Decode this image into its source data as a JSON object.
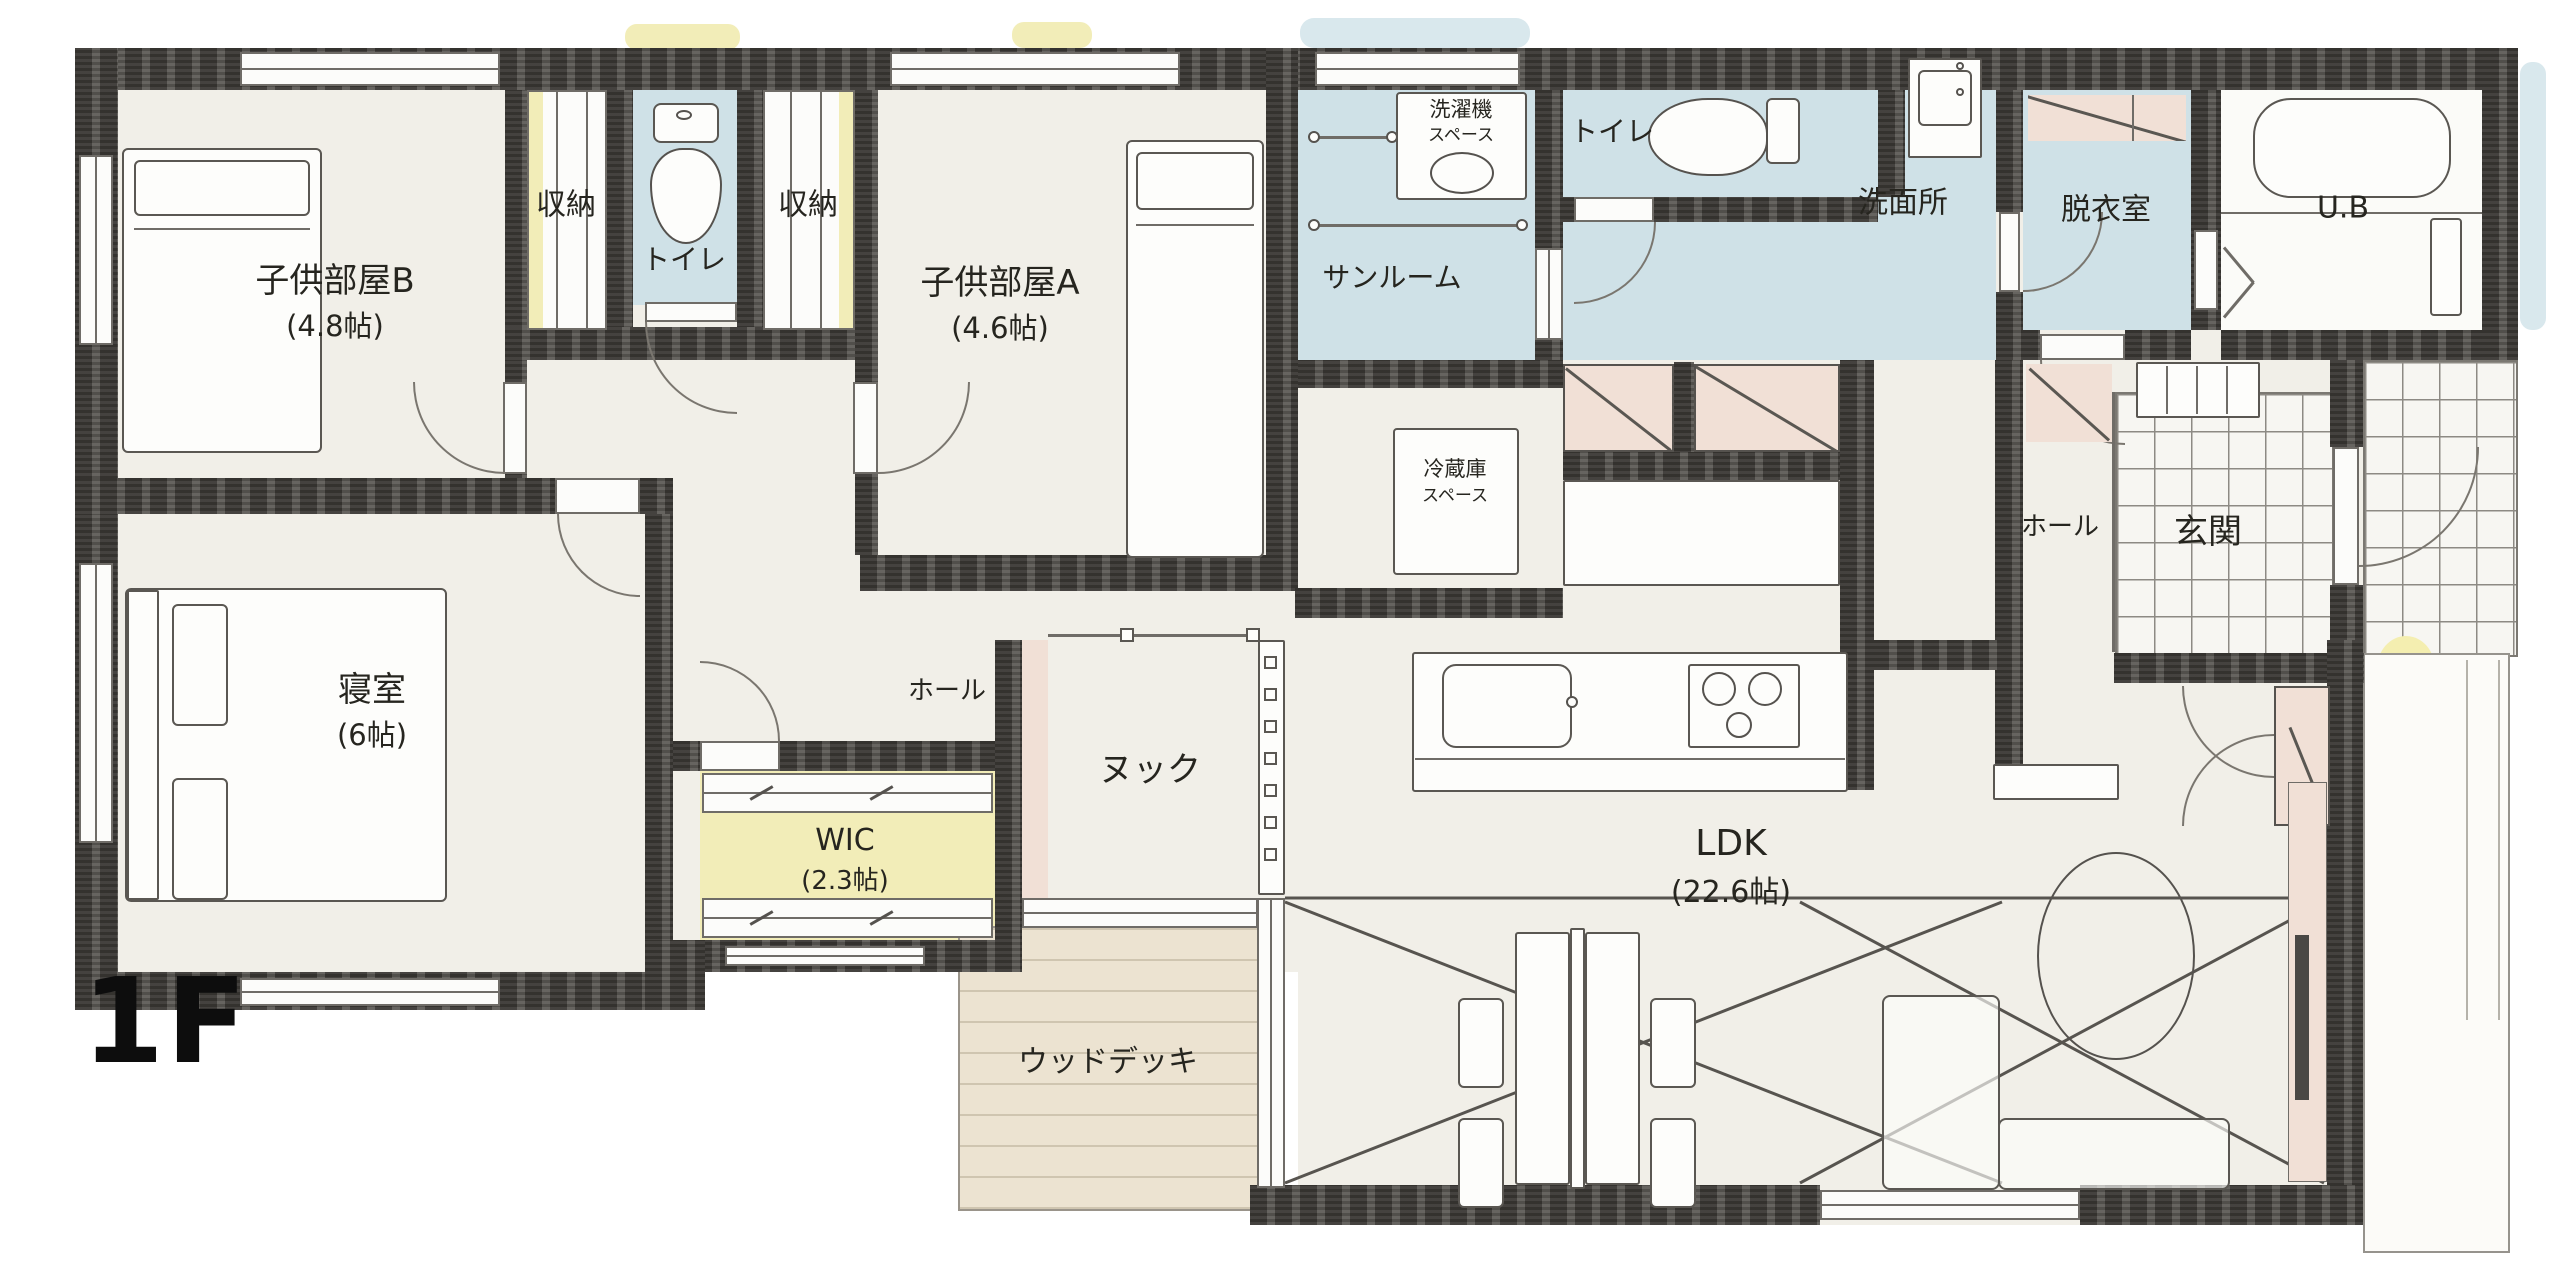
{
  "floor_label": "1F",
  "colors": {
    "wall": "#4d4a46",
    "floor": "#f1efe8",
    "wet_area_blue": "#cfe1e7",
    "accent_yellow": "#f2edb8",
    "closet_pink": "#f1e0d6",
    "deck_beige": "#ece3d1"
  },
  "rooms": {
    "kids_room_b": {
      "name": "子供部屋B",
      "size": "(4.8帖)"
    },
    "closet_left": {
      "name": "収納"
    },
    "toilet_upper": {
      "name": "トイレ"
    },
    "closet_right": {
      "name": "収納"
    },
    "kids_room_a": {
      "name": "子供部屋A",
      "size": "(4.6帖)"
    },
    "sunroom": {
      "name": "サンルーム"
    },
    "washer_space": {
      "line1": "洗濯機",
      "line2": "スペース"
    },
    "toilet_right": {
      "name": "トイレ"
    },
    "washroom": {
      "name": "洗面所"
    },
    "dressing_room": {
      "name": "脱衣室"
    },
    "unit_bath": {
      "name": "U.B"
    },
    "fridge_space": {
      "line1": "冷蔵庫",
      "line2": "スペース"
    },
    "hall_entry": {
      "name": "ホール"
    },
    "entrance": {
      "name": "玄関"
    },
    "bedroom": {
      "name": "寝室",
      "size": "(6帖)"
    },
    "hall_center": {
      "name": "ホール"
    },
    "wic": {
      "name": "WIC",
      "size": "(2.3帖)"
    },
    "nook": {
      "name": "ヌック"
    },
    "ldk": {
      "name": "LDK",
      "size": "(22.6帖)"
    },
    "wood_deck": {
      "name": "ウッドデッキ"
    }
  }
}
